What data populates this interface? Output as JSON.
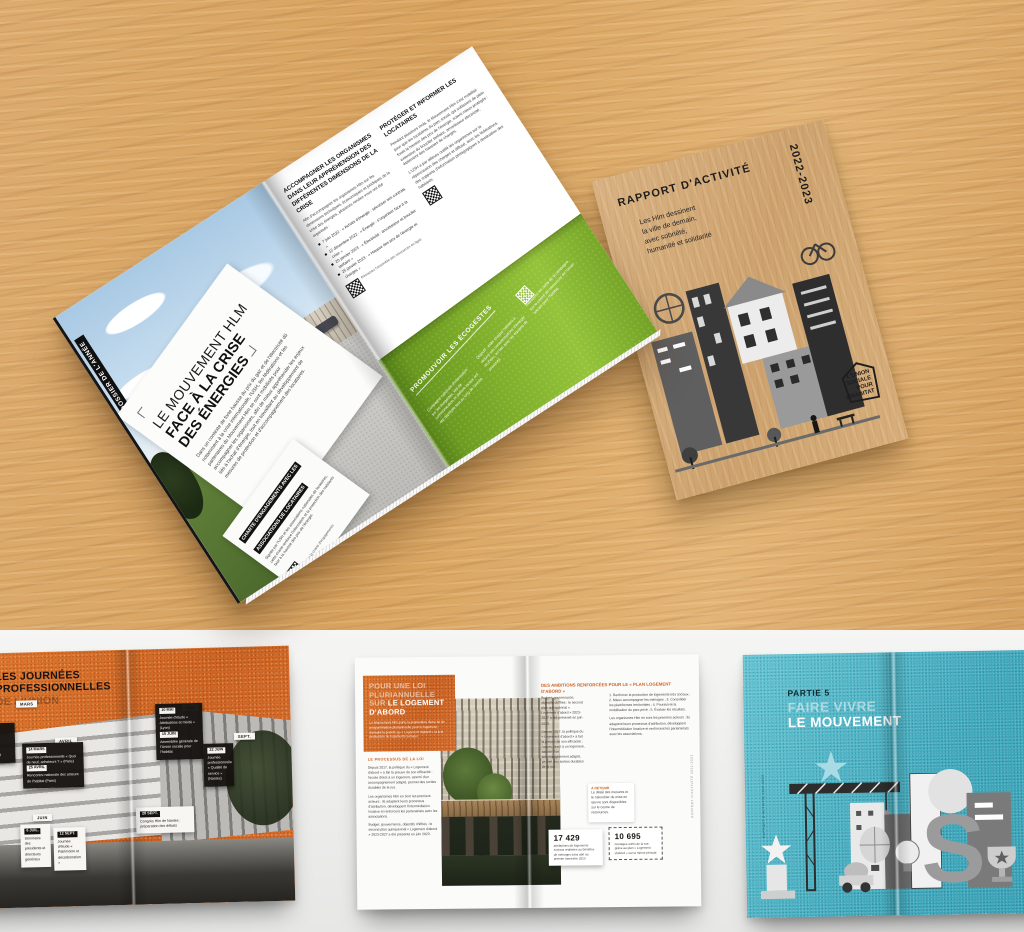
{
  "colors": {
    "wood": "#d9a866",
    "floor": "#efefee",
    "green": "#7fae2b",
    "orange": "#d96d2b",
    "teal": "#43afc3",
    "kraft": "#d3aa78"
  },
  "magazine": {
    "section_tab": "DOSSIER DE L'ANNÉE",
    "title": {
      "line1": "LE MOUVEMENT HLM",
      "line2": "FACE À LA CRISE",
      "line3": "DES ÉNERGIES"
    },
    "intro": "Dans un contexte de forte hausse du prix du gaz et de l'électricité dû notamment à la crise internationale, l'USH, les fédérations et les partenaires du Mouvement Hlm se sont mobilisés pour accompagner les organismes, afin de mieux appréhender les enjeux liés à l'achat d'énergie, tout en travaillant au développement de mesures de protection et d'accompagnement des locataires.",
    "charte_card": {
      "header": "CHARTE D'ENGAGEMENTS AVEC LES ASSOCIATIONS DE LOCATAIRES",
      "body": "Signée par l'USH et les associations nationales de locataires, cette charte renforce l'information et la protection des habitants face à la hausse des prix de l'énergie.",
      "qr_caption": "Lire la charte d'engagements"
    },
    "right_page": {
      "heading1": "ACCOMPAGNER LES ORGANISMES DANS LEUR APPRÉHENSION DES DIFFÉRENTES DIMENSIONS DE LA CRISE",
      "para1": "Afin d'accompagner les organismes Hlm sur les dimensions techniques, économiques et juridiques de la crise des énergies, plusieurs rendez-vous ont été organisés :",
      "timeline": [
        "7 juin 2022 · « Achats d'énergie : sécuriser ses contrats »",
        "12 décembre 2022 · « Énergie : s'organiser face à la crise »",
        "20 janvier 2023 · « Électricité : amortisseur et bouclier tarifaire »",
        "25 janvier 2023 · « Hausse des prix de l'énergie et charges »"
      ],
      "qr1_caption": "Retrouvez l'ensemble des ressources en ligne",
      "heading2": "PROTÉGER ET INFORMER LES LOCATAIRES",
      "para2": "Pendant plusieurs mois, le Mouvement Hlm s'est mobilisé pour que les locataires du parc social, qui subissent de plein fouet la hausse des prix de l'énergie, soient mieux protégés : extension du bouclier tarifaire, amortisseur électricité, étalement des hausses de charges.",
      "para2b": "L'USH a par ailleurs outillé les organismes sur la répercussion des charges et diffusé, avec les fédérations, des supports d'information pédagogiques à destination des habitants.",
      "green_panel": {
        "title": "PROMOUVOIR LES ÉCOGESTES",
        "col1": "Campagne nationale d'information sur les écogestes, kits de communication et ateliers locaux ont été déployés tout au long de l'année.",
        "col2": "Objectif : aider chaque habitant à réduire ses consommations d'énergie et d'eau, en lien avec les équipes de proximité.",
        "col3": "Retrouvez les outils de la campagne sur le centre de ressources de l'Union sociale pour l'habitat."
      }
    }
  },
  "report_cover": {
    "title": "RAPPORT D'ACTIVITÉ",
    "years": "2022-2023",
    "subtitle_lines": [
      "Les Hlm dessinent",
      "la ville de demain,",
      "avec sobriété,",
      "humanité et solidarité"
    ],
    "logo_lines": [
      "L'UNION",
      "SOCIALE",
      "POUR",
      "L'HABITAT"
    ]
  },
  "floor": {
    "journees": {
      "headline_lines": [
        "LES JOURNÉES",
        "PROFESSIONNELLES",
        "DE L'UNION"
      ],
      "chips": [
        "MARS",
        "AVRIL",
        "MAI",
        "JUIN",
        "SEPT."
      ],
      "black_boxes": [
        {
          "date": "14 MARS",
          "text": "Journée professionnelle « Quoi de neuf, acheteurs ? » (Paris)"
        },
        {
          "date": "25 AVRIL",
          "text": "Rencontre nationale des acteurs de l'habitat (Paris)"
        },
        {
          "date": "10 MAI",
          "text": "Journée d'étude « Attributions et mixité » (Lyon)"
        },
        {
          "date": "15 JUIN",
          "text": "Assemblée générale de l'Union sociale pour l'habitat"
        },
        {
          "date": "22 JUIN",
          "text": "Journée professionnelle « Qualité de service » (Nantes)"
        }
      ],
      "left_boxes": [
        {
          "date": "31 JANV.",
          "text": "Vœux de l'Union aux partenaires"
        },
        {
          "date": "9 FÉVR.",
          "text": "Comité exécutif de l'USH"
        }
      ],
      "white_boxes": [
        {
          "date": "6 JUIL.",
          "text": "Séminaire des présidents et directeurs généraux"
        },
        {
          "date": "12 SEPT.",
          "text": "Journée d'étude « Patrimoine et décarbonation »"
        },
        {
          "date": "28 SEPT.",
          "text": "Congrès Hlm de Nantes : préparation des débats"
        }
      ]
    },
    "logement": {
      "h1a": "POUR UNE LOI",
      "h1b": "PLURIANNUELLE",
      "h1c": "SUR ",
      "h1d": "LE LOGEMENT",
      "h1e": "D'ABORD",
      "intro": "Le Mouvement Hlm porte la proposition d'une loi de programmation pluriannuelle pour le logement, donnant la priorité au « Logement d'abord » et à la production de logements sociaux.",
      "sec_heading": "LE PROCESSUS DE LA LOI",
      "left_body": "Depuis 2017, la politique du « Logement d'abord » a fait la preuve de son efficacité : l'accès direct à un logement, assorti d'un accompagnement adapté, permet des sorties durables de la rue.",
      "left_body2": "Les organismes Hlm en sont les premiers acteurs : ils adaptent leurs processus d'attribution, développent l'intermédiation locative et renforcent les partenariats avec les associations.",
      "right_h": "DES AMBITIONS RENFORCÉES POUR LE « PLAN LOGEMENT D'ABORD »",
      "right_c1": "Budget, gouvernance, objectifs chiffrés : le second plan quinquennal « Logement d'abord » 2023-2027 a été présenté en juin 2023.",
      "right_c2": "1. Renforcer la production de logements très sociaux ; 2. Mieux accompagner les ménages ; 3. Consolider les plateformes territoriales ; 4. Poursuivre la mobilisation du parc privé ; 5. Évaluer les résultats.",
      "note_lead": "À RETENIR",
      "note_body": "Le détail des mesures et le calendrier de mise en œuvre sont disponibles sur le centre de ressources.",
      "stats": [
        {
          "value": "17 429",
          "label": "attributions de logements sociaux réalisées au bénéfice de ménages sans abri au premier semestre 2023"
        },
        {
          "value": "10 695",
          "label": "ménages sortis de la rue grâce au plan « Logement d'abord » sur la même période"
        }
      ],
      "edge_text": "RAPPORT D'ACTIVITÉ 2022-2023"
    },
    "mouvement": {
      "part": "PARTIE 5",
      "title_light": "FAIRE VIVRE",
      "title_bold": "LE MOUVEMENT",
      "edge_text": "RAPPORT D'ACTIVITÉ 2022-2023"
    }
  }
}
